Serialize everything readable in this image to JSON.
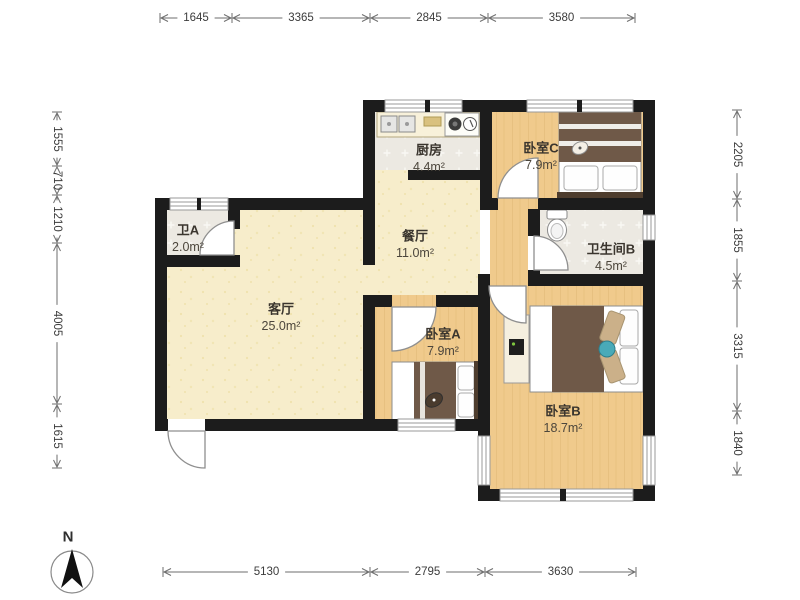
{
  "plan": {
    "rooms": {
      "kitchen": {
        "name": "厨房",
        "area": "4.4m²"
      },
      "bedroomC": {
        "name": "卧室C",
        "area": "7.9m²"
      },
      "bathA": {
        "name": "卫A",
        "area": "2.0m²"
      },
      "dining": {
        "name": "餐厅",
        "area": "11.0m²"
      },
      "bathB": {
        "name": "卫生间B",
        "area": "4.5m²"
      },
      "living": {
        "name": "客厅",
        "area": "25.0m²"
      },
      "bedroomA": {
        "name": "卧室A",
        "area": "7.9m²"
      },
      "bedroomB": {
        "name": "卧室B",
        "area": "18.7m²"
      }
    },
    "dimensions": {
      "top": {
        "labels": [
          "1645",
          "3365",
          "2845",
          "3580"
        ]
      },
      "bottom": {
        "labels": [
          "5130",
          "2795",
          "3630"
        ]
      },
      "left": {
        "labels": [
          "1555",
          "710",
          "1210",
          "4005",
          "1615"
        ]
      },
      "right": {
        "labels": [
          "2205",
          "1855",
          "3315",
          "1840"
        ]
      }
    },
    "compass": {
      "label": "N"
    }
  },
  "colors": {
    "wall": "#1c1c1c",
    "floor_beige": "#f7edcb",
    "floor_tile": "#ece9e2",
    "floor_wood": "#f0ca8c",
    "furniture_dark": "#6f5948",
    "dimension": "#6e6e6e"
  }
}
